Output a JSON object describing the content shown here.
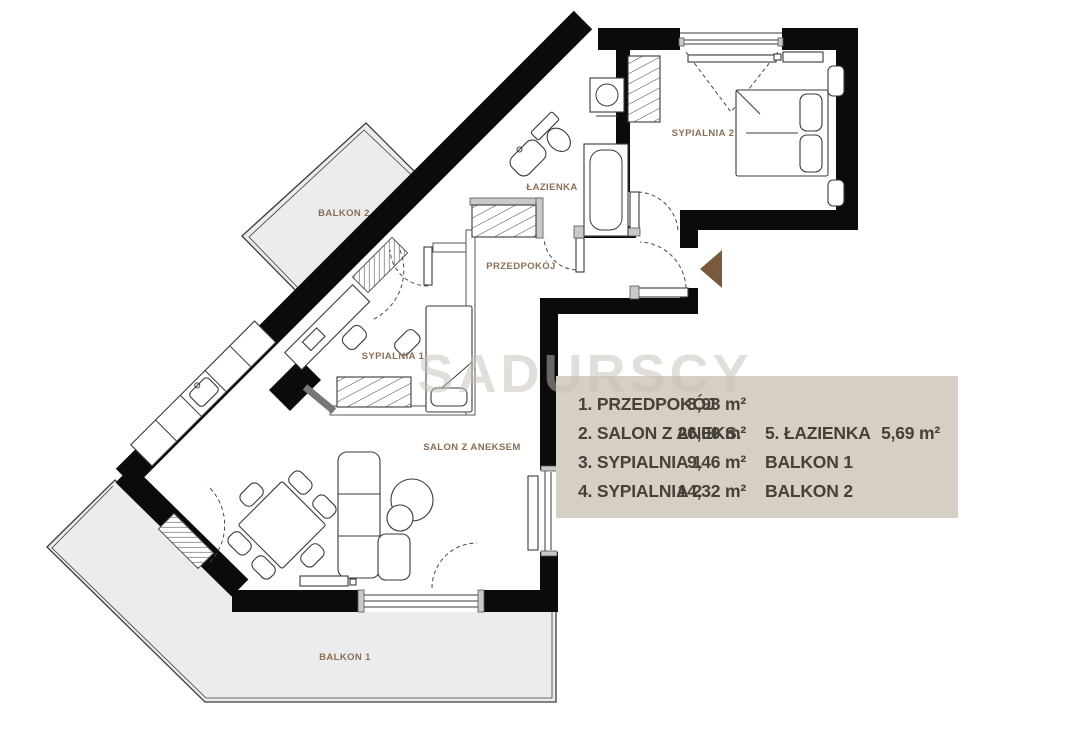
{
  "watermark": "SADURSCY",
  "plan": {
    "rooms": {
      "sypialnia2": "SYPIALNIA 2",
      "lazienka": "ŁAZIENKA",
      "przedpokoj": "PRZEDPOKÓJ",
      "sypialnia1": "SYPIALNIA 1",
      "salon": "SALON Z ANEKSEM",
      "balkon1": "BALKON 1",
      "balkon2": "BALKON 2"
    },
    "entrance_arrow_direction": "left"
  },
  "legend": {
    "left": [
      {
        "name": "1. PRZEDPOKÓJ",
        "area": "8,93 m²"
      },
      {
        "name": "2. SALON Z ANEKS.",
        "area": "26,00 m²"
      },
      {
        "name": "3. SYPIALNIA 1",
        "area": "9,46 m²"
      },
      {
        "name": "4. SYPIALNIA 2",
        "area": "14,32 m²"
      }
    ],
    "right": [
      {
        "name": "5. ŁAZIENKA",
        "area": "5,69 m²"
      },
      {
        "name": "BALKON 1",
        "area": ""
      },
      {
        "name": "BALKON 2",
        "area": ""
      }
    ]
  },
  "colors": {
    "wall": "#0b0b0b",
    "room_label": "#8a6e55",
    "legend_bg": "#d6cfc3",
    "legend_text": "#46403a",
    "arrow": "#7a5a3e",
    "balcony_fill": "#ececee",
    "watermark": "#c6c0b8"
  }
}
